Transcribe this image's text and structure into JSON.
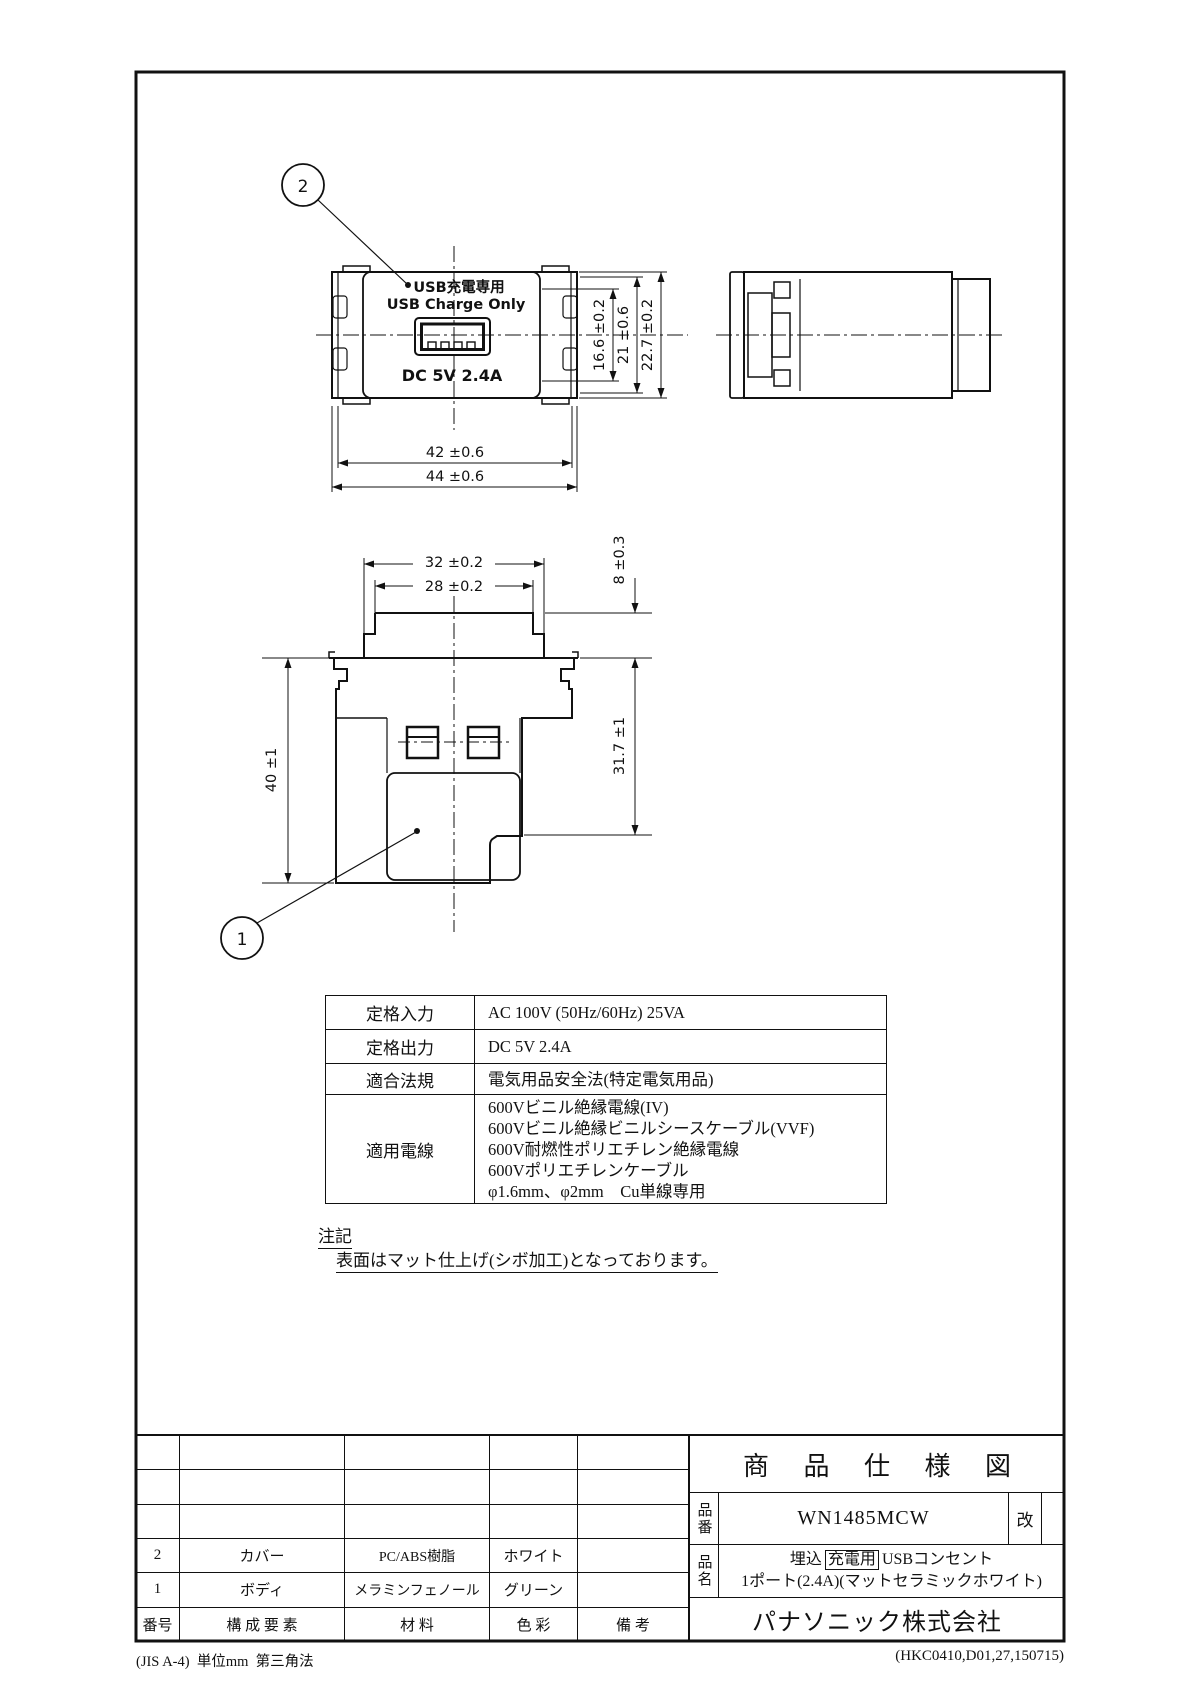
{
  "drawing": {
    "balloons": {
      "cover": "2",
      "body": "1"
    },
    "front_face": {
      "usb_jp": "USB充電専用",
      "usb_en": "USB Charge Only",
      "dc": "DC 5V 2.4A"
    },
    "dims": {
      "front_usb_h": "16.6 ±0.2",
      "front_inner_h": "21 ±0.6",
      "front_outer_h": "22.7 ±0.2",
      "front_inner_w": "42 ±0.6",
      "front_outer_w": "44 ±0.6",
      "rear_tab_outer_w": "32 ±0.2",
      "rear_tab_inner_w": "28 ±0.2",
      "rear_tab_h": "8 ±0.3",
      "rear_total_h": "40 ±1",
      "rear_body_h": "31.7 ±1"
    }
  },
  "spec_table": {
    "rows": [
      {
        "label": "定格入力",
        "value": "AC 100V (50Hz/60Hz) 25VA"
      },
      {
        "label": "定格出力",
        "value": "DC 5V 2.4A"
      },
      {
        "label": "適合法規",
        "value": "電気用品安全法(特定電気用品)"
      },
      {
        "label": "適用電線",
        "lines": [
          "600Vビニル絶縁電線(IV)",
          "600Vビニル絶縁ビニルシースケーブル(VVF)",
          "600V耐燃性ポリエチレン絶縁電線",
          "600Vポリエチレンケーブル",
          "φ1.6mm、φ2mm　Cu単線専用"
        ]
      }
    ]
  },
  "note": {
    "title": "注記",
    "body": "表面はマット仕上げ(シボ加工)となっております。"
  },
  "parts_table": {
    "headers": {
      "no": "番号",
      "component": "構 成 要 素",
      "material": "材  料",
      "color": "色  彩",
      "remarks": "備  考"
    },
    "rows": [
      {
        "no": "2",
        "component": "カバー",
        "material": "PC/ABS樹脂",
        "color": "ホワイト",
        "remarks": ""
      },
      {
        "no": "1",
        "component": "ボディ",
        "material": "メラミンフェノール",
        "color": "グリーン",
        "remarks": ""
      }
    ]
  },
  "title_block": {
    "title": "商 品 仕 様 図",
    "part_no_label": "品番",
    "part_no": "WN1485MCW",
    "rev_label": "改",
    "name_label": "品名",
    "name_pre": "埋込",
    "name_boxed": "充電用",
    "name_post": "USBコンセント",
    "name_line2": "1ポート(2.4A)(マットセラミックホワイト)",
    "company": "パナソニック株式会社"
  },
  "footer": {
    "left": "(JIS A-4)  単位mm  第三角法",
    "right": "(HKC0410,D01,27,150715)"
  }
}
